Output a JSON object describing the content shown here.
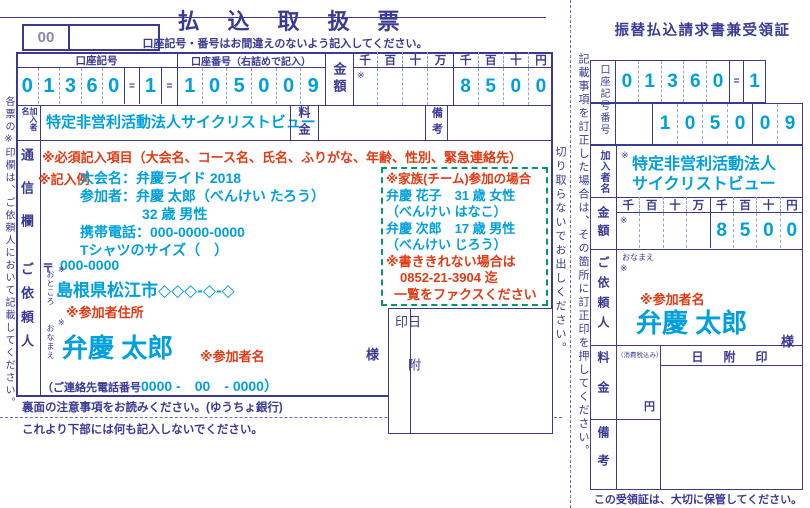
{
  "colors": {
    "navy": "#3a3a94",
    "blue": "#00a0dc",
    "red": "#e23a14",
    "green": "#00996a",
    "gray": "#8787a8"
  },
  "slip": {
    "corner_code": "00",
    "title": "払　込　取　扱　票",
    "subtitle": "口座記号・番号はお間違えのないよう記入してください。",
    "side_note": "各票の※印欄は、ご依頼人において記載してください。",
    "account": {
      "symbol_label": "口座記号",
      "symbol_digits": [
        "0",
        "1",
        "3",
        "6",
        "0"
      ],
      "separator": "=",
      "check_digit": "1",
      "number_label": "口座番号（右詰めで記入）",
      "number_digits": [
        "1",
        "0",
        "5",
        "0",
        "0",
        "9"
      ]
    },
    "amount": {
      "label": "金額",
      "asterisk": "※",
      "units": [
        "千",
        "百",
        "十",
        "万",
        "千",
        "百",
        "十",
        "円"
      ],
      "digits": [
        "",
        "",
        "",
        "",
        "8",
        "5",
        "0",
        "0"
      ]
    },
    "payee": {
      "label": "加入者名",
      "name": "特定非営利活動法人サイクリストビュー"
    },
    "fee_label": "料金",
    "notes_label": "備考",
    "correspondence": {
      "label": "通信欄",
      "required_note": "※必須記入項目（大会名、コース名、氏名、ふりがな、年齢、性別、緊急連絡先）",
      "example_label": "※記入例",
      "example_line1": "大会名：弁慶ライド 2018",
      "example_line2": "参加者：弁慶 太郎（べんけい たろう）",
      "example_line3": "32 歳 男性",
      "example_line4": "携帯電話：000-0000-0000",
      "example_line5": "Tシャツのサイズ（　）"
    },
    "family_box": {
      "title": "※家族(チーム)参加の場合",
      "member1": "弁慶 花子　31 歳 女性",
      "member1_kana": "（べんけい はなこ）",
      "member2": "弁慶 次郎　17 歳 男性",
      "member2_kana": "（べんけい じろう）",
      "overflow1": "※書ききれない場合は",
      "overflow2": "0852-21-3904 迄",
      "overflow3": "一覧をファクスください"
    },
    "client": {
      "label": "ご依頼人",
      "postal_mark": "〒",
      "postal_code": "000-0000",
      "asterisk": "※",
      "address_label": "おところ",
      "address": "島根県松江市◇◇◇-◇-◇",
      "address_annotation": "※参加者住所",
      "name_label": "おなまえ",
      "name": "弁慶 太郎",
      "name_annotation": "※参加者名",
      "honorific": "様",
      "phone_label": "（ご連絡先電話番号",
      "phone_value": "0000 -　00　- 0000）"
    },
    "date_stamp_label": "日附印",
    "footer_note1": "裏面の注意事項をお読みください。(ゆうちょ銀行)",
    "footer_note2": "これより下部には何も記入しないでください。"
  },
  "cut_strip": {
    "left_note": "切り取らないでお出しください。",
    "right_note": "記載事項を訂正した場合は、その箇所に訂正印を押してください。"
  },
  "receipt": {
    "title": "振替払込請求書兼受領証",
    "account_label": "口座記号番号",
    "symbol_digits": [
      "0",
      "1",
      "3",
      "6",
      "0"
    ],
    "separator": "=",
    "check_digit": "1",
    "number_digits": [
      "1",
      "0",
      "5",
      "0",
      "0",
      "9"
    ],
    "payee": {
      "label": "加入者名",
      "asterisk": "※",
      "name_line1": "特定非営利活動法人",
      "name_line2": "サイクリストビュー"
    },
    "amount": {
      "label": "金額",
      "asterisk": "※",
      "units": [
        "千",
        "百",
        "十",
        "万",
        "千",
        "百",
        "十",
        "円"
      ],
      "digits": [
        "",
        "",
        "",
        "",
        "8",
        "5",
        "0",
        "0"
      ]
    },
    "client": {
      "label": "ご依頼人",
      "name_label": "おなまえ",
      "asterisk": "※",
      "name_annotation": "※参加者名",
      "name": "弁慶 太郎",
      "honorific": "様"
    },
    "fee": {
      "label": "料金",
      "tax_note": "（消費税込み）",
      "yen": "円"
    },
    "date_stamp_label": "日　附　印",
    "notes_label": "備考",
    "footer": "この受領証は、大切に保管してください。"
  }
}
